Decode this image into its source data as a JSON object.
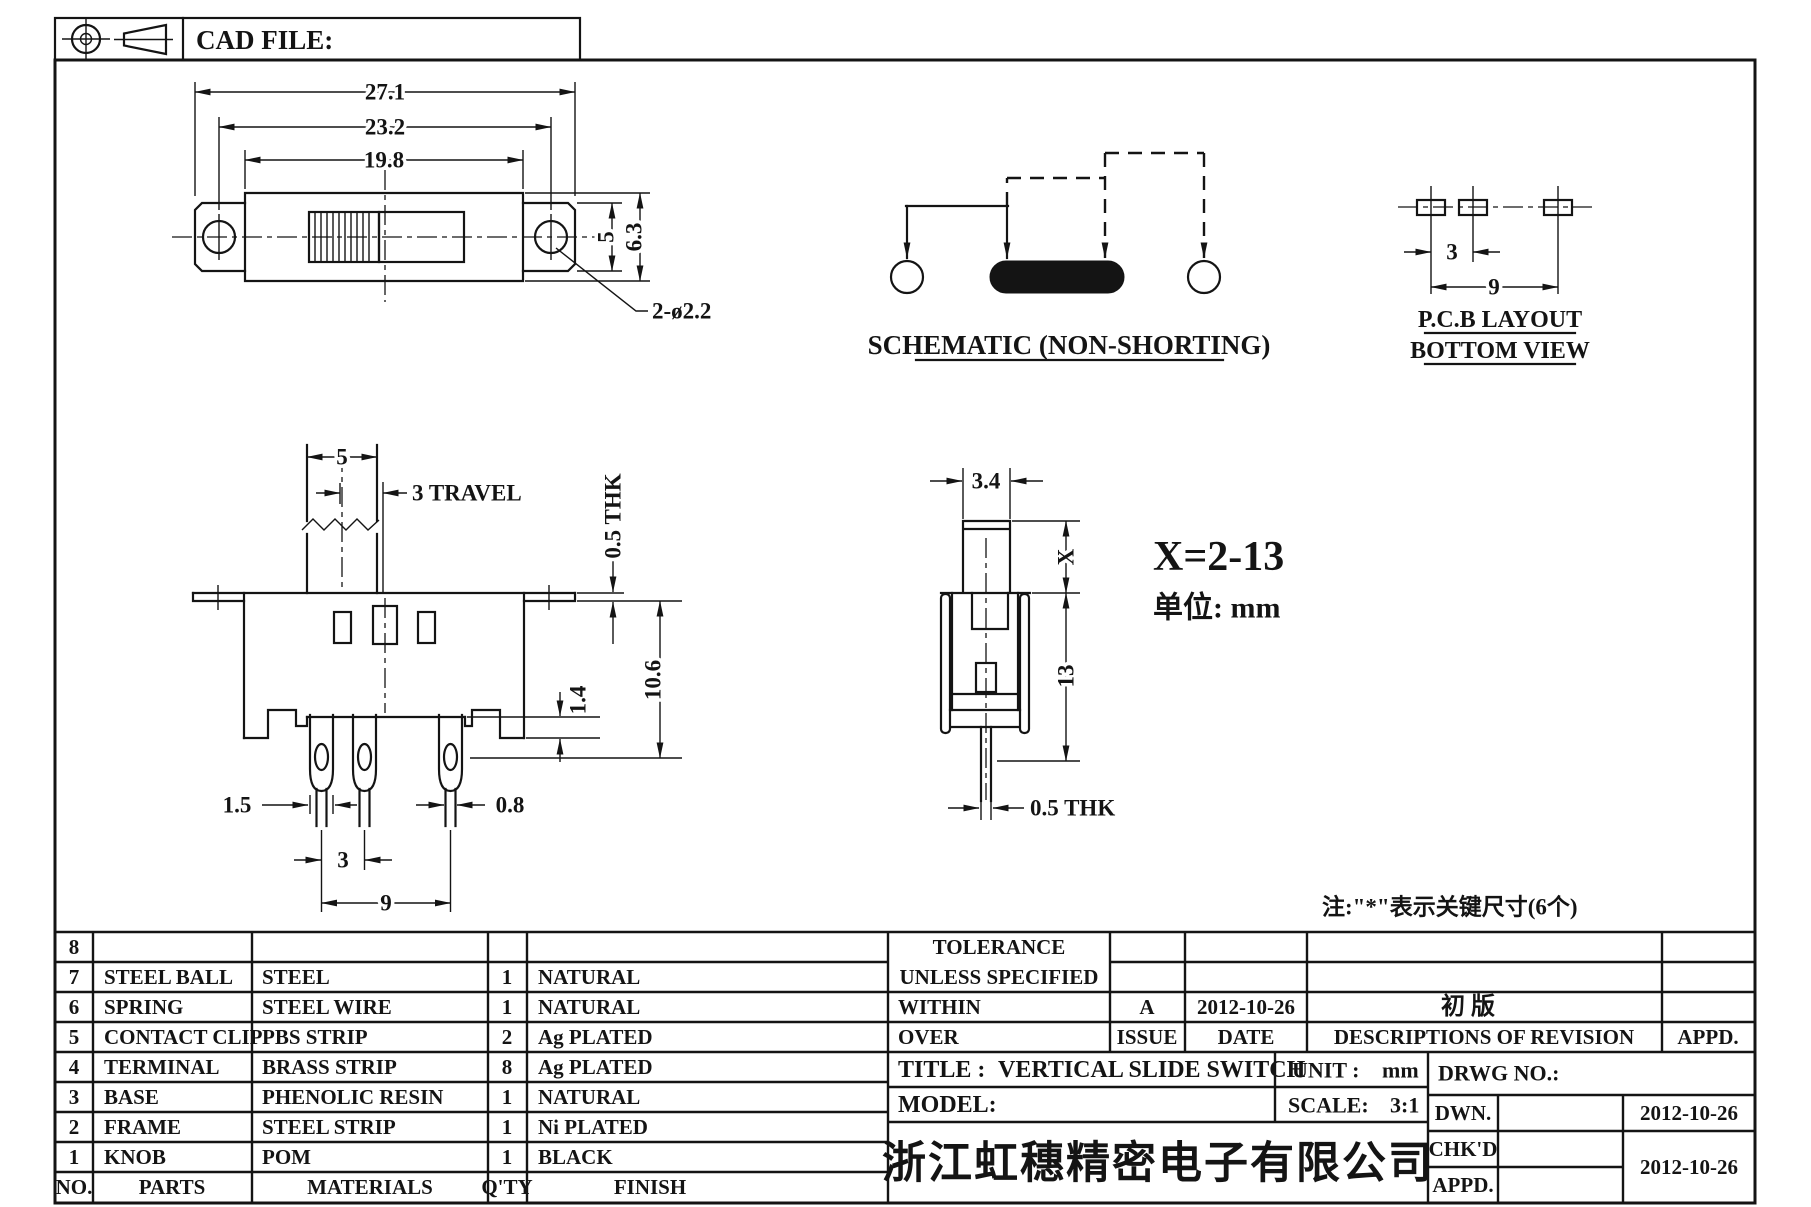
{
  "header_strip": {
    "cad_file": "CAD FILE:"
  },
  "top_view": {
    "dim_overall": "27.1",
    "dim_hole_span": "23.2",
    "dim_cover": "19.8",
    "dim_inner_h": "5",
    "dim_outer_h": "6.3",
    "hole_callout": "2-ø2.2"
  },
  "schematic": {
    "caption": "SCHEMATIC (NON-SHORTING)"
  },
  "pcb_view": {
    "dim_pitch": "3",
    "dim_span": "9",
    "caption1": "P.C.B LAYOUT",
    "caption2": "BOTTOM VIEW"
  },
  "front_view": {
    "dim_knob": "5",
    "dim_travel": "3 TRAVEL",
    "dim_flange_thk": "0.5 THK",
    "dim_height": "10.6",
    "dim_skirt": "1.4",
    "dim_term": "1.5",
    "dim_tip": "0.8",
    "dim_pitch": "3",
    "dim_span": "9"
  },
  "side_view": {
    "dim_knob": "3.4",
    "dim_x": "X",
    "dim_body": "13",
    "dim_pin_thk": "0.5 THK",
    "x_range": "X=2-13",
    "unit_note": "单位: mm"
  },
  "note": "注:\"*\"表示关键尺寸(6个)",
  "parts_table": {
    "headers": {
      "no": "NO.",
      "parts": "PARTS",
      "materials": "MATERIALS",
      "qty": "Q'TY",
      "finish": "FINISH"
    },
    "rows": [
      {
        "no": "8",
        "part": "",
        "material": "",
        "qty": "",
        "finish": ""
      },
      {
        "no": "7",
        "part": "STEEL BALL",
        "material": "STEEL",
        "qty": "1",
        "finish": "NATURAL"
      },
      {
        "no": "6",
        "part": "SPRING",
        "material": "STEEL WIRE",
        "qty": "1",
        "finish": "NATURAL"
      },
      {
        "no": "5",
        "part": "CONTACT CLIP",
        "material": "PBS STRIP",
        "qty": "2",
        "finish": "Ag PLATED"
      },
      {
        "no": "4",
        "part": "TERMINAL",
        "material": "BRASS STRIP",
        "qty": "8",
        "finish": "Ag PLATED"
      },
      {
        "no": "3",
        "part": "BASE",
        "material": "PHENOLIC RESIN",
        "qty": "1",
        "finish": "NATURAL"
      },
      {
        "no": "2",
        "part": "FRAME",
        "material": "STEEL STRIP",
        "qty": "1",
        "finish": "Ni PLATED"
      },
      {
        "no": "1",
        "part": "KNOB",
        "material": "POM",
        "qty": "1",
        "finish": "BLACK"
      }
    ]
  },
  "title_block": {
    "tolerance1": "TOLERANCE",
    "tolerance2": "UNLESS SPECIFIED",
    "within": "WITHIN",
    "over": "OVER",
    "issue_value": "A",
    "issue_label": "ISSUE",
    "date_value": "2012-10-26",
    "date_label": "DATE",
    "revision_desc": "初 版",
    "revision_label": "DESCRIPTIONS OF REVISION",
    "appd_label": "APPD.",
    "title_label": "TITLE :",
    "title_value": "VERTICAL SLIDE SWITCH",
    "unit_label": "UNIT :",
    "unit_value": "mm",
    "drwg_label": "DRWG NO.:",
    "model_label": "MODEL:",
    "scale_label": "SCALE:",
    "scale_value": "3:1",
    "company": "浙江虹穗精密电子有限公司",
    "dwn_label": "DWN.",
    "dwn_date": "2012-10-26",
    "chkd_label": "CHK'D",
    "appd_row_label": "APPD.",
    "chkd_appd_date": "2012-10-26"
  }
}
